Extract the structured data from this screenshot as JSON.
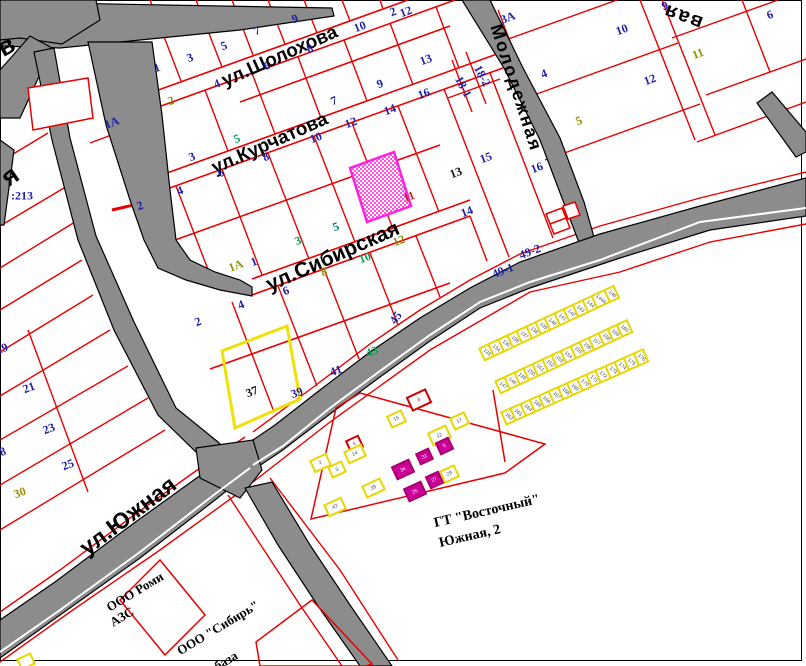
{
  "map": {
    "width": 806,
    "height": 666
  },
  "colors": {
    "parcel_line": "#e80000",
    "road_fill": "#8c8c8c",
    "road_casing": "#000000",
    "navy": "#1d1da8",
    "green": "#00a550",
    "olive": "#8f8f00",
    "teal": "#007a7a",
    "red": "#cc2020",
    "black": "#111111",
    "selected_magenta": "#ff21dd",
    "selected_yellow": "#f0e005",
    "garage_magenta": "#cc0099"
  },
  "streets": [
    {
      "label": "ул.Шолохова",
      "x": 280,
      "y": 57,
      "rot": -24,
      "size": 19
    },
    {
      "label": "ул.Курчатова",
      "x": 270,
      "y": 144,
      "rot": -24,
      "size": 19
    },
    {
      "label": "ул.Сибирская",
      "x": 333,
      "y": 257,
      "rot": -24,
      "size": 21
    },
    {
      "label": "Молодежная",
      "x": 516,
      "y": 88,
      "rot": 72,
      "size": 18
    },
    {
      "label": "вая",
      "x": 683,
      "y": 16,
      "rot": 200,
      "size": 20
    },
    {
      "label": "ул.Южная",
      "x": 128,
      "y": 516,
      "rot": -37,
      "size": 23
    },
    {
      "label": "я",
      "x": 10,
      "y": 176,
      "rot": -35,
      "size": 26
    },
    {
      "label": "в",
      "x": 6,
      "y": 46,
      "rot": -30,
      "size": 26
    }
  ],
  "landmarks": [
    {
      "label": "ГТ \"Восточный\"",
      "x": 487,
      "y": 512,
      "rot": -13,
      "size": 14
    },
    {
      "label": "Южная, 2",
      "x": 470,
      "y": 537,
      "rot": -13,
      "size": 14
    },
    {
      "label": "ООО Роми",
      "x": 135,
      "y": 592,
      "rot": -31,
      "size": 13
    },
    {
      "label": "АЗС",
      "x": 122,
      "y": 617,
      "rot": -31,
      "size": 13
    },
    {
      "label": "ООО \"Сибирь\"",
      "x": 218,
      "y": 628,
      "rot": -31,
      "size": 13
    },
    {
      "label": "база",
      "x": 226,
      "y": 661,
      "rot": -31,
      "size": 13
    }
  ],
  "parcel_numbers": [
    {
      "t": "2",
      "x": 393,
      "y": 12,
      "c": "navy"
    },
    {
      "t": "3",
      "x": 190,
      "y": 58,
      "c": "navy"
    },
    {
      "t": "5",
      "x": 224,
      "y": 46,
      "c": "navy"
    },
    {
      "t": "7",
      "x": 257,
      "y": 31,
      "c": "navy"
    },
    {
      "t": "9",
      "x": 295,
      "y": 19,
      "c": "navy"
    },
    {
      "t": "10",
      "x": 360,
      "y": 27,
      "c": "navy"
    },
    {
      "t": "12",
      "x": 406,
      "y": 12,
      "c": "navy"
    },
    {
      "t": "4",
      "x": 217,
      "y": 84,
      "c": "navy"
    },
    {
      "t": "6",
      "x": 267,
      "y": 66,
      "c": "navy"
    },
    {
      "t": "8",
      "x": 310,
      "y": 49,
      "c": "navy"
    },
    {
      "t": "13",
      "x": 426,
      "y": 60,
      "c": "navy"
    },
    {
      "t": "7",
      "x": 334,
      "y": 101,
      "c": "navy"
    },
    {
      "t": "9",
      "x": 380,
      "y": 84,
      "c": "navy"
    },
    {
      "t": "2",
      "x": 171,
      "y": 101,
      "c": "olive"
    },
    {
      "t": "3",
      "x": 192,
      "y": 157,
      "c": "navy"
    },
    {
      "t": "5",
      "x": 237,
      "y": 139,
      "c": "green"
    },
    {
      "t": "8",
      "x": 266,
      "y": 157,
      "c": "navy"
    },
    {
      "t": "6",
      "x": 221,
      "y": 173,
      "c": "navy"
    },
    {
      "t": "10",
      "x": 316,
      "y": 138,
      "c": "navy"
    },
    {
      "t": "12",
      "x": 351,
      "y": 123,
      "c": "navy"
    },
    {
      "t": "14",
      "x": 390,
      "y": 110,
      "c": "navy"
    },
    {
      "t": "16",
      "x": 424,
      "y": 94,
      "c": "navy"
    },
    {
      "t": "18-2",
      "x": 482,
      "y": 76,
      "c": "navy",
      "r": 62
    },
    {
      "t": "18-1",
      "x": 463,
      "y": 87,
      "c": "navy",
      "r": 62
    },
    {
      "t": "15",
      "x": 486,
      "y": 158,
      "c": "navy"
    },
    {
      "t": "13",
      "x": 456,
      "y": 173,
      "c": "black"
    },
    {
      "t": "16",
      "x": 537,
      "y": 168,
      "c": "navy"
    },
    {
      "t": "14",
      "x": 467,
      "y": 212,
      "c": "navy"
    },
    {
      "t": "1А",
      "x": 236,
      "y": 266,
      "c": "olive"
    },
    {
      "t": "1",
      "x": 254,
      "y": 262,
      "c": "navy"
    },
    {
      "t": "3",
      "x": 298,
      "y": 241,
      "c": "green"
    },
    {
      "t": "5",
      "x": 336,
      "y": 227,
      "c": "teal"
    },
    {
      "t": "8",
      "x": 324,
      "y": 272,
      "c": "olive"
    },
    {
      "t": "10",
      "x": 365,
      "y": 258,
      "c": "green"
    },
    {
      "t": "12",
      "x": 399,
      "y": 241,
      "c": "olive"
    },
    {
      "t": "11",
      "x": 409,
      "y": 197,
      "c": "red"
    },
    {
      "t": "49-1",
      "x": 503,
      "y": 271,
      "c": "navy"
    },
    {
      "t": "49-2",
      "x": 530,
      "y": 252,
      "c": "navy"
    },
    {
      "t": "2",
      "x": 198,
      "y": 322,
      "c": "navy"
    },
    {
      "t": "4",
      "x": 241,
      "y": 305,
      "c": "navy"
    },
    {
      "t": "6",
      "x": 286,
      "y": 291,
      "c": "navy"
    },
    {
      "t": "37",
      "x": 252,
      "y": 392,
      "c": "black"
    },
    {
      "t": "39",
      "x": 297,
      "y": 393,
      "c": "navy"
    },
    {
      "t": "41",
      "x": 336,
      "y": 371,
      "c": "navy"
    },
    {
      "t": "43",
      "x": 372,
      "y": 352,
      "c": "green"
    },
    {
      "t": "45",
      "x": 396,
      "y": 318,
      "c": "navy",
      "r": -55
    },
    {
      "t": "3А",
      "x": 508,
      "y": 18,
      "c": "navy"
    },
    {
      "t": "4",
      "x": 544,
      "y": 74,
      "c": "navy"
    },
    {
      "t": "5",
      "x": 579,
      "y": 121,
      "c": "olive"
    },
    {
      "t": "10",
      "x": 622,
      "y": 30,
      "c": "navy"
    },
    {
      "t": "9",
      "x": 665,
      "y": 6,
      "c": "navy"
    },
    {
      "t": "6",
      "x": 770,
      "y": 15,
      "c": "navy"
    },
    {
      "t": "11",
      "x": 698,
      "y": 54,
      "c": "olive"
    },
    {
      "t": "12",
      "x": 650,
      "y": 80,
      "c": "navy"
    },
    {
      "t": "1А",
      "x": 112,
      "y": 123,
      "c": "navy"
    },
    {
      "t": "1",
      "x": 157,
      "y": 68,
      "c": "navy"
    },
    {
      "t": "2",
      "x": 140,
      "y": 206,
      "c": "navy"
    },
    {
      "t": "4",
      "x": 180,
      "y": 191,
      "c": "navy"
    },
    {
      "t": ":213",
      "x": 22,
      "y": 196,
      "c": "navy",
      "r": 0
    },
    {
      "t": "19",
      "x": 2,
      "y": 349,
      "c": "navy"
    },
    {
      "t": "21",
      "x": 29,
      "y": 388,
      "c": "navy"
    },
    {
      "t": "23",
      "x": 49,
      "y": 429,
      "c": "navy"
    },
    {
      "t": "25",
      "x": 68,
      "y": 465,
      "c": "navy"
    },
    {
      "t": "30",
      "x": 20,
      "y": 493,
      "c": "olive"
    },
    {
      "t": "18",
      "x": 0,
      "y": 453,
      "c": "navy"
    }
  ],
  "garages": {
    "title": "ГТ \"Восточный\" Южная, 2",
    "rows": [
      {
        "x": 478,
        "y": 348,
        "rot": -25,
        "numbers": [
          "133",
          "134",
          "135",
          "136",
          "137",
          "138",
          "139",
          "140",
          "141",
          "142",
          "143",
          "144",
          "144А",
          "146"
        ]
      },
      {
        "x": 494,
        "y": 381,
        "rot": -25,
        "numbers": [
          "147",
          "148",
          "149",
          "150",
          "151",
          "152",
          "153",
          "154",
          "155",
          "156",
          "157",
          "158",
          "159",
          "160"
        ]
      },
      {
        "x": 500,
        "y": 412,
        "rot": -24,
        "numbers": [
          "162",
          "163",
          "164",
          "165",
          "166",
          "167",
          "168",
          "169",
          "170",
          "171",
          "172",
          "173",
          "174",
          "175",
          "176"
        ]
      }
    ],
    "boxes": [
      {
        "x": 408,
        "y": 392,
        "w": 18,
        "h": 12,
        "style": "redbox",
        "label": "8"
      },
      {
        "x": 388,
        "y": 412,
        "w": 13,
        "h": 10,
        "style": "yellow",
        "label": "15"
      },
      {
        "x": 451,
        "y": 414,
        "w": 13,
        "h": 10,
        "style": "yellow",
        "label": "17"
      },
      {
        "x": 429,
        "y": 428,
        "w": 17,
        "h": 11,
        "style": "yellow",
        "label": "12"
      },
      {
        "x": 437,
        "y": 439,
        "w": 11,
        "h": 10,
        "style": "magenta",
        "label": "5"
      },
      {
        "x": 347,
        "y": 437,
        "w": 11,
        "h": 10,
        "style": "redbox",
        "label": "6"
      },
      {
        "x": 345,
        "y": 447,
        "w": 16,
        "h": 10,
        "style": "yellow",
        "label": "14"
      },
      {
        "x": 311,
        "y": 456,
        "w": 15,
        "h": 10,
        "style": "yellow",
        "label": "2"
      },
      {
        "x": 329,
        "y": 463,
        "w": 12,
        "h": 9,
        "style": "yellow",
        "label": "3"
      },
      {
        "x": 393,
        "y": 462,
        "w": 16,
        "h": 11,
        "style": "magenta",
        "label": "34"
      },
      {
        "x": 417,
        "y": 450,
        "w": 11,
        "h": 9,
        "style": "magenta",
        "label": "31"
      },
      {
        "x": 441,
        "y": 467,
        "w": 13,
        "h": 10,
        "style": "yellow",
        "label": "29"
      },
      {
        "x": 427,
        "y": 473,
        "w": 11,
        "h": 10,
        "style": "magenta",
        "label": "27"
      },
      {
        "x": 363,
        "y": 481,
        "w": 17,
        "h": 10,
        "style": "yellow",
        "label": "39"
      },
      {
        "x": 405,
        "y": 484,
        "w": 16,
        "h": 11,
        "style": "magenta",
        "label": "25"
      },
      {
        "x": 325,
        "y": 500,
        "w": 16,
        "h": 10,
        "style": "yellow",
        "label": "43"
      },
      {
        "x": 18,
        "y": 655,
        "w": 12,
        "h": 9,
        "style": "yellow",
        "label": ""
      }
    ]
  }
}
